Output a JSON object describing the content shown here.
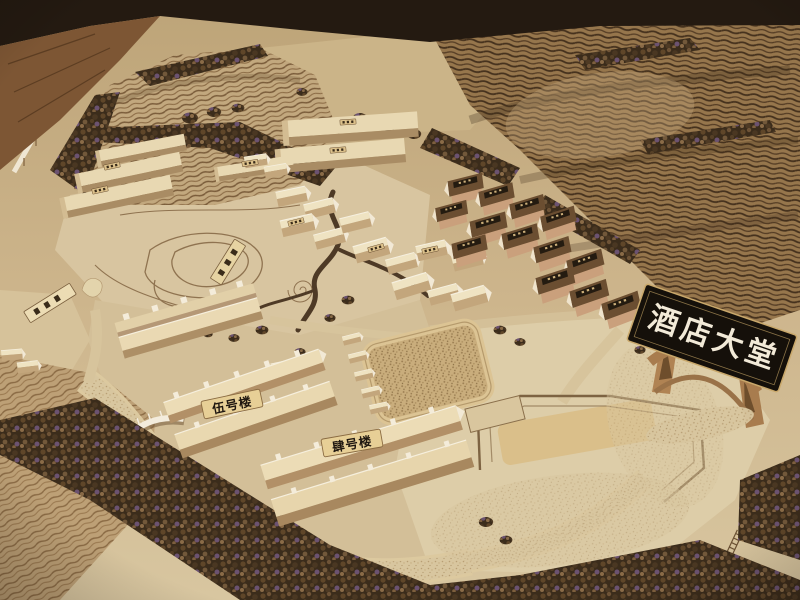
{
  "signs": {
    "hotel_lobby": "酒店大堂",
    "building_5": "伍号楼",
    "building_4": "肆号楼"
  },
  "colors": {
    "background_dark": "#241a11",
    "wood_floor": "#7d5634",
    "terrain_base": "#c6ad83",
    "terrain_pale": "#dccaa4",
    "contour_line": "#6b5134",
    "foliage_dark": "#3b2c1b",
    "building_wood": "#ecdcb6",
    "house_roof_dark": "#6b4e31",
    "sign_black": "#15100a",
    "sign_text": "#f2ead8",
    "label_tag": "#e7cf96",
    "label_text": "#1f1710"
  }
}
